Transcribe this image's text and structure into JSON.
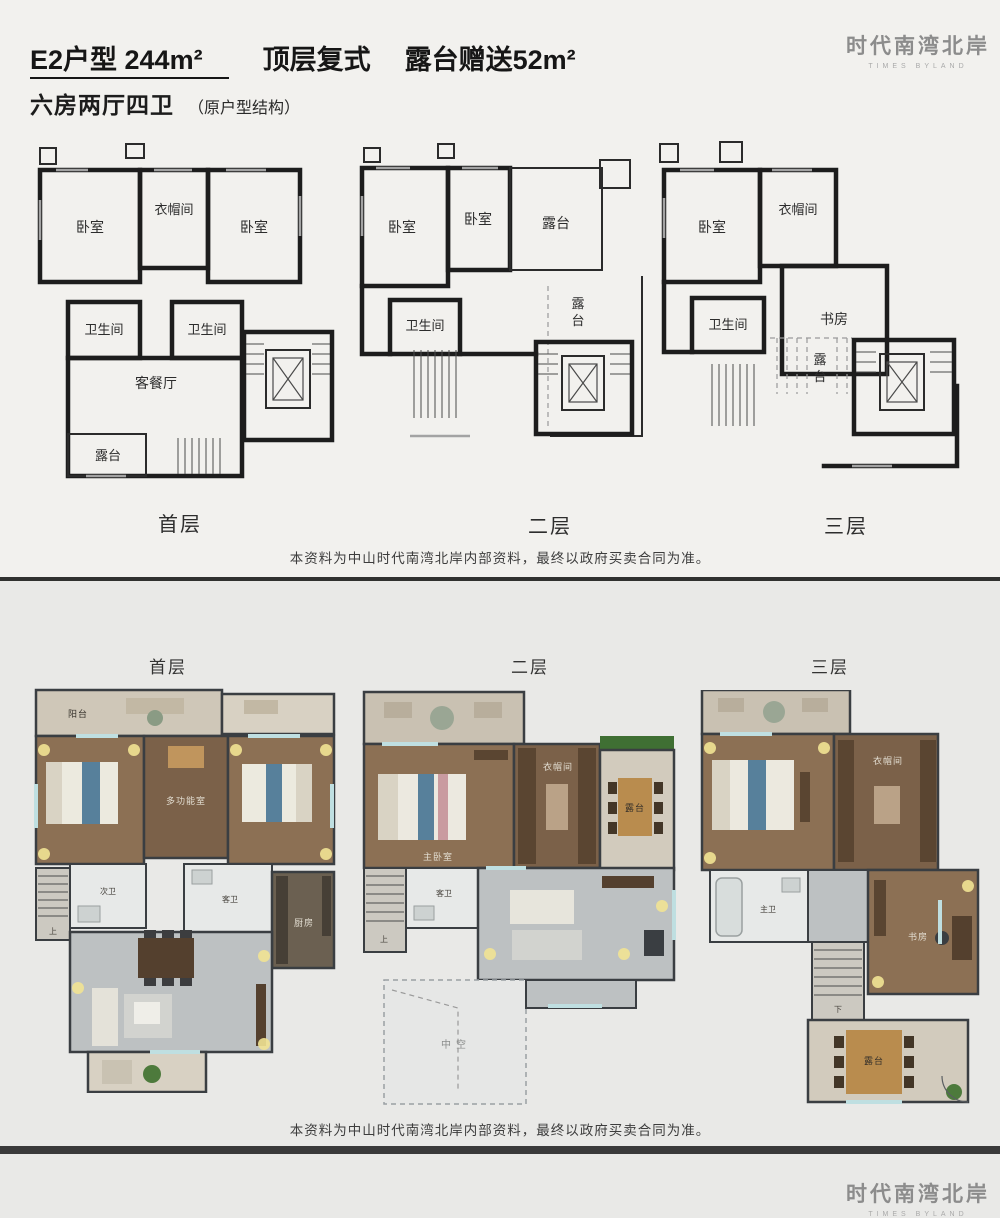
{
  "header": {
    "title_main": "E2户型  244m²",
    "title_type": "顶层复式",
    "title_bonus": "露台赠送52m²",
    "subtitle": "六房两厅四卫",
    "subtitle_note": "（原户型结构）"
  },
  "logo": {
    "cn": "时代南湾北岸",
    "en": "TIMES BYLAND"
  },
  "disclaimer": "本资料为中山时代南湾北岸内部资料，最终以政府买卖合同为准。",
  "top_section": {
    "plans": [
      {
        "label": "首层",
        "rooms": {
          "bedroom_left": "卧室",
          "cloakroom": "衣帽间",
          "bedroom_right": "卧室",
          "bath_left": "卫生间",
          "bath_right": "卫生间",
          "living": "客餐厅",
          "terrace": "露台"
        }
      },
      {
        "label": "二层",
        "rooms": {
          "bedroom_left": "卧室",
          "bedroom_mid": "卧室",
          "terrace_top": "露台",
          "bath": "卫生间",
          "terrace_right": "露台"
        }
      },
      {
        "label": "三层",
        "rooms": {
          "bedroom": "卧室",
          "cloakroom": "衣帽间",
          "bath": "卫生间",
          "study": "书房",
          "terrace": "露台"
        }
      }
    ]
  },
  "bottom_section": {
    "plans": [
      {
        "label": "首层",
        "rooms": {
          "balcony": "阳台",
          "multi": "多功能室",
          "bath_a": "次卫",
          "bath_b": "客卫",
          "kitchen": "厨房",
          "stairs": "上"
        }
      },
      {
        "label": "二层",
        "rooms": {
          "bedroom": "主卧室",
          "cloakroom": "衣帽间",
          "terrace": "露台",
          "bath": "客卫",
          "void": "中空",
          "stairs": "上"
        }
      },
      {
        "label": "三层",
        "rooms": {
          "bedroom": "卧室",
          "cloakroom": "衣帽间",
          "bath": "主卫",
          "study": "书房",
          "terrace": "露台",
          "stairs": "下"
        }
      }
    ]
  },
  "colors": {
    "line_black": "#1d1d1d",
    "wall_dark": "#3a3e42",
    "wood_floor": "#8c7054",
    "wood_floor_dark": "#7b6149",
    "hall_gray": "#bdc1c2",
    "terrace_stone": "#cfc7b8",
    "bath_white": "#e7e9e8",
    "window_teal": "#bfdfe1",
    "plant_green": "#4d7a3c",
    "glow_yellow": "#f1e393",
    "logo_gray": "#8c8c8c",
    "background_top": "#f2f1ee",
    "background_bottom": "#e9e9e7"
  }
}
